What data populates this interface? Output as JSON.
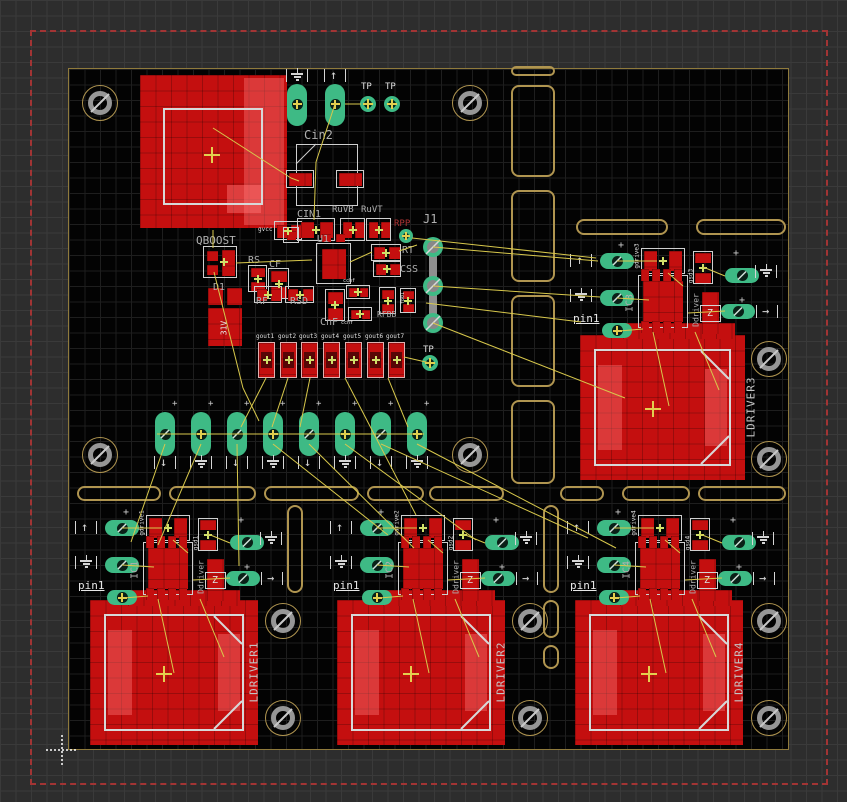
{
  "canvas": {
    "kind": "pcb-layout-editor-canvas",
    "width": 847,
    "height": 802
  },
  "colors": {
    "background_outer": "#2d2d2d",
    "background_board": "#030303",
    "copper_red": "#c40f0f",
    "copper_light": "#e85555",
    "pad_green": "#3eba85",
    "pad_hole_dark": "#0a2118",
    "silk_white": "#dcdcdc",
    "name_gray": "#b0b0b0",
    "net_white": "#e8e8e8",
    "airwire_yellow": "#d8c84c",
    "outline_tan": "#b09550",
    "dimension_red": "#a23434",
    "cross_yellow": "#e3cf4f",
    "plus_green": "#cfe06a",
    "hole_gray": "#969696",
    "red_text": "#b03535"
  },
  "board": {
    "x": 68,
    "y": 68,
    "w": 721,
    "h": 682
  },
  "dash_rect": {
    "x": 30,
    "y": 30,
    "w": 794,
    "h": 751
  },
  "origin_marker": {
    "x": 62,
    "y": 750
  },
  "tp_labels": [
    {
      "text": "TP",
      "x": 361,
      "y": 82
    },
    {
      "text": "TP",
      "x": 385,
      "y": 82
    },
    {
      "text": "TP",
      "x": 423,
      "y": 345
    }
  ],
  "test_points": [
    {
      "x": 368,
      "y": 104
    },
    {
      "x": 392,
      "y": 104
    },
    {
      "x": 430,
      "y": 363
    },
    {
      "x": 406,
      "y": 236
    }
  ],
  "part_labels": [
    {
      "text": "Cin2",
      "x": 304,
      "y": 128,
      "size": 12
    },
    {
      "text": "CIN1",
      "x": 297,
      "y": 209,
      "size": 10
    },
    {
      "text": "RuVB",
      "x": 332,
      "y": 205,
      "size": 9
    },
    {
      "text": "RuVT",
      "x": 361,
      "y": 205,
      "size": 9
    },
    {
      "text": "U1",
      "x": 317,
      "y": 234,
      "size": 10
    },
    {
      "text": "J1",
      "x": 423,
      "y": 212,
      "size": 12
    },
    {
      "text": "RPP",
      "x": 394,
      "y": 219,
      "size": 9,
      "color": "#b03535"
    },
    {
      "text": "RT",
      "x": 402,
      "y": 245,
      "size": 10
    },
    {
      "text": "CSS",
      "x": 400,
      "y": 264,
      "size": 10
    },
    {
      "text": "RS",
      "x": 248,
      "y": 255,
      "size": 10
    },
    {
      "text": "CF",
      "x": 269,
      "y": 259,
      "size": 10
    },
    {
      "text": "D1",
      "x": 213,
      "y": 282,
      "size": 10
    },
    {
      "text": "RF",
      "x": 256,
      "y": 296,
      "size": 10
    },
    {
      "text": "RSD",
      "x": 290,
      "y": 296,
      "size": 10
    },
    {
      "text": "CnF",
      "x": 320,
      "y": 317,
      "size": 10
    },
    {
      "text": "RFBB",
      "x": 377,
      "y": 310,
      "size": 8
    },
    {
      "text": "QBOOST",
      "x": 196,
      "y": 234,
      "size": 11
    }
  ],
  "net_labels": [
    {
      "text": "gvcc",
      "x": 258,
      "y": 226,
      "size": 6
    },
    {
      "text": "cchf",
      "x": 343,
      "y": 278,
      "size": 5
    },
    {
      "text": "cchf",
      "x": 341,
      "y": 320,
      "size": 5
    },
    {
      "text": "fb01",
      "x": 403,
      "y": 298,
      "size": 5,
      "rot": true
    },
    {
      "text": "31V",
      "x": 224,
      "y": 328,
      "size": 8,
      "rot": true,
      "color": "#e8e8e8"
    }
  ],
  "gout_labels": [
    "gout1",
    "gout2",
    "gout3",
    "gout4",
    "gout5",
    "gout6",
    "gout7"
  ],
  "gout_row": {
    "x0": 258,
    "pitch": 21.7,
    "y": 342,
    "w": 17,
    "h": 36
  },
  "mid_row": {
    "x0": 165,
    "pitch": 36,
    "count": 8,
    "y": 412
  },
  "clusters": [
    {
      "ref": "IC1",
      "origin": [
        78,
        507
      ],
      "pin1": "pin1",
      "diode_ref": "Ddriver",
      "cap_net": "gdrive1",
      "res_net": "gsd1",
      "diode_glyph": "Z"
    },
    {
      "ref": "IC2",
      "origin": [
        333,
        507
      ],
      "pin1": "pin1",
      "diode_ref": "Ddriver",
      "cap_net": "gdrive2",
      "res_net": "gsd2",
      "diode_glyph": "Z"
    },
    {
      "ref": "IC4",
      "origin": [
        570,
        507
      ],
      "pin1": "pin1",
      "diode_ref": "Ddriver",
      "cap_net": "gdrive4",
      "res_net": "gsd4",
      "diode_glyph": "Z"
    },
    {
      "ref": "IC3",
      "origin": [
        573,
        240
      ],
      "pin1": "pin1",
      "diode_ref": "Ddriver",
      "cap_net": "gdrive3",
      "res_net": "gsd3",
      "diode_glyph": "Z"
    }
  ],
  "driver_pads": [
    {
      "ref": "LDRIVER1",
      "x": 90,
      "y": 600,
      "w": 168,
      "h": 145,
      "lx": 254,
      "ly": 672
    },
    {
      "ref": "LDRIVER2",
      "x": 337,
      "y": 600,
      "w": 168,
      "h": 145,
      "lx": 501,
      "ly": 672
    },
    {
      "ref": "LDRIVER4",
      "x": 575,
      "y": 600,
      "w": 168,
      "h": 145,
      "lx": 739,
      "ly": 672
    },
    {
      "ref": "LDRIVER3",
      "x": 580,
      "y": 335,
      "w": 165,
      "h": 145,
      "lx": 751,
      "ly": 407
    }
  ],
  "holes": [
    [
      100,
      103
    ],
    [
      470,
      103
    ],
    [
      100,
      455
    ],
    [
      470,
      455
    ],
    [
      769,
      359
    ],
    [
      769,
      459
    ],
    [
      283,
      621
    ],
    [
      283,
      718
    ],
    [
      530,
      621
    ],
    [
      530,
      718
    ],
    [
      769,
      621
    ],
    [
      769,
      718
    ]
  ],
  "bars": [
    [
      511,
      66,
      44,
      10
    ],
    [
      511,
      85,
      44,
      92
    ],
    [
      511,
      190,
      44,
      92
    ],
    [
      511,
      295,
      44,
      92
    ],
    [
      511,
      400,
      44,
      84
    ],
    [
      576,
      219,
      92,
      16
    ],
    [
      696,
      219,
      90,
      16
    ],
    [
      77,
      486,
      84,
      15
    ],
    [
      169,
      486,
      87,
      15
    ],
    [
      264,
      486,
      95,
      15
    ],
    [
      367,
      486,
      57,
      15
    ],
    [
      429,
      486,
      75,
      15
    ],
    [
      560,
      486,
      44,
      15
    ],
    [
      622,
      486,
      68,
      15
    ],
    [
      698,
      486,
      88,
      15
    ],
    [
      287,
      505,
      16,
      88
    ],
    [
      543,
      505,
      16,
      88
    ],
    [
      543,
      600,
      16,
      38
    ],
    [
      543,
      645,
      16,
      24
    ]
  ],
  "airwires": [
    [
      213,
      128,
      291,
      178
    ],
    [
      291,
      178,
      299,
      181
    ],
    [
      335,
      104,
      316,
      162
    ],
    [
      316,
      162,
      314,
      220
    ],
    [
      345,
      104,
      361,
      104
    ],
    [
      213,
      230,
      213,
      248
    ],
    [
      214,
      272,
      243,
      388
    ],
    [
      243,
      388,
      259,
      421
    ],
    [
      236,
      263,
      312,
      260
    ],
    [
      350,
      262,
      372,
      252
    ],
    [
      399,
      251,
      417,
      245
    ],
    [
      433,
      247,
      598,
      261
    ],
    [
      433,
      286,
      600,
      297
    ],
    [
      426,
      303,
      581,
      322
    ],
    [
      412,
      238,
      596,
      258
    ],
    [
      433,
      323,
      625,
      398
    ],
    [
      266,
      378,
      241,
      427
    ],
    [
      288,
      378,
      272,
      427
    ],
    [
      310,
      378,
      300,
      427
    ],
    [
      388,
      378,
      408,
      427
    ],
    [
      345,
      378,
      416,
      515
    ],
    [
      157,
      434,
      424,
      434
    ],
    [
      165,
      444,
      131,
      542
    ],
    [
      201,
      444,
      158,
      545
    ],
    [
      237,
      444,
      239,
      566
    ],
    [
      273,
      444,
      388,
      535
    ],
    [
      309,
      444,
      414,
      548
    ],
    [
      345,
      444,
      476,
      540
    ],
    [
      381,
      444,
      588,
      538
    ],
    [
      417,
      444,
      616,
      548
    ],
    [
      430,
      363,
      404,
      357
    ]
  ],
  "cluster_wires": [
    [
      44,
      21,
      84,
      21
    ],
    [
      44,
      58,
      76,
      60
    ],
    [
      46,
      91,
      70,
      89
    ],
    [
      130,
      27,
      152,
      36
    ],
    [
      152,
      71,
      115,
      73
    ],
    [
      95,
      33,
      110,
      46
    ],
    [
      80,
      92,
      96,
      166
    ],
    [
      122,
      92,
      146,
      150
    ]
  ]
}
